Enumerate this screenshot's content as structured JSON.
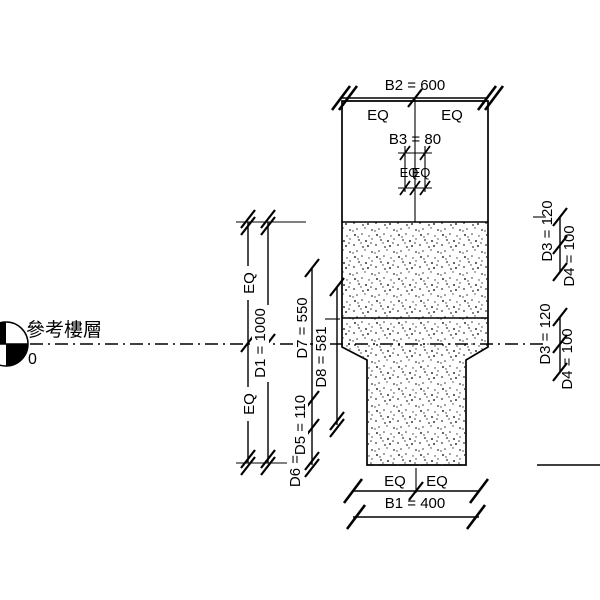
{
  "level": {
    "name": "參考樓層",
    "elevation": "0"
  },
  "dimensions": {
    "b1": "B1 = 400",
    "b2": "B2 = 600",
    "b3": "B3 = 80",
    "d1": "D1 = 1000",
    "d3": "D3 = 120",
    "d4": "D4 = 100",
    "d5": "D5 = 110",
    "d6": "D6 =",
    "d7": "D7 = 550",
    "d8": "D8 = 581",
    "eq": "EQ"
  },
  "colors": {
    "line": "#000000",
    "background": "#ffffff",
    "hatch_dot": "#333333"
  }
}
